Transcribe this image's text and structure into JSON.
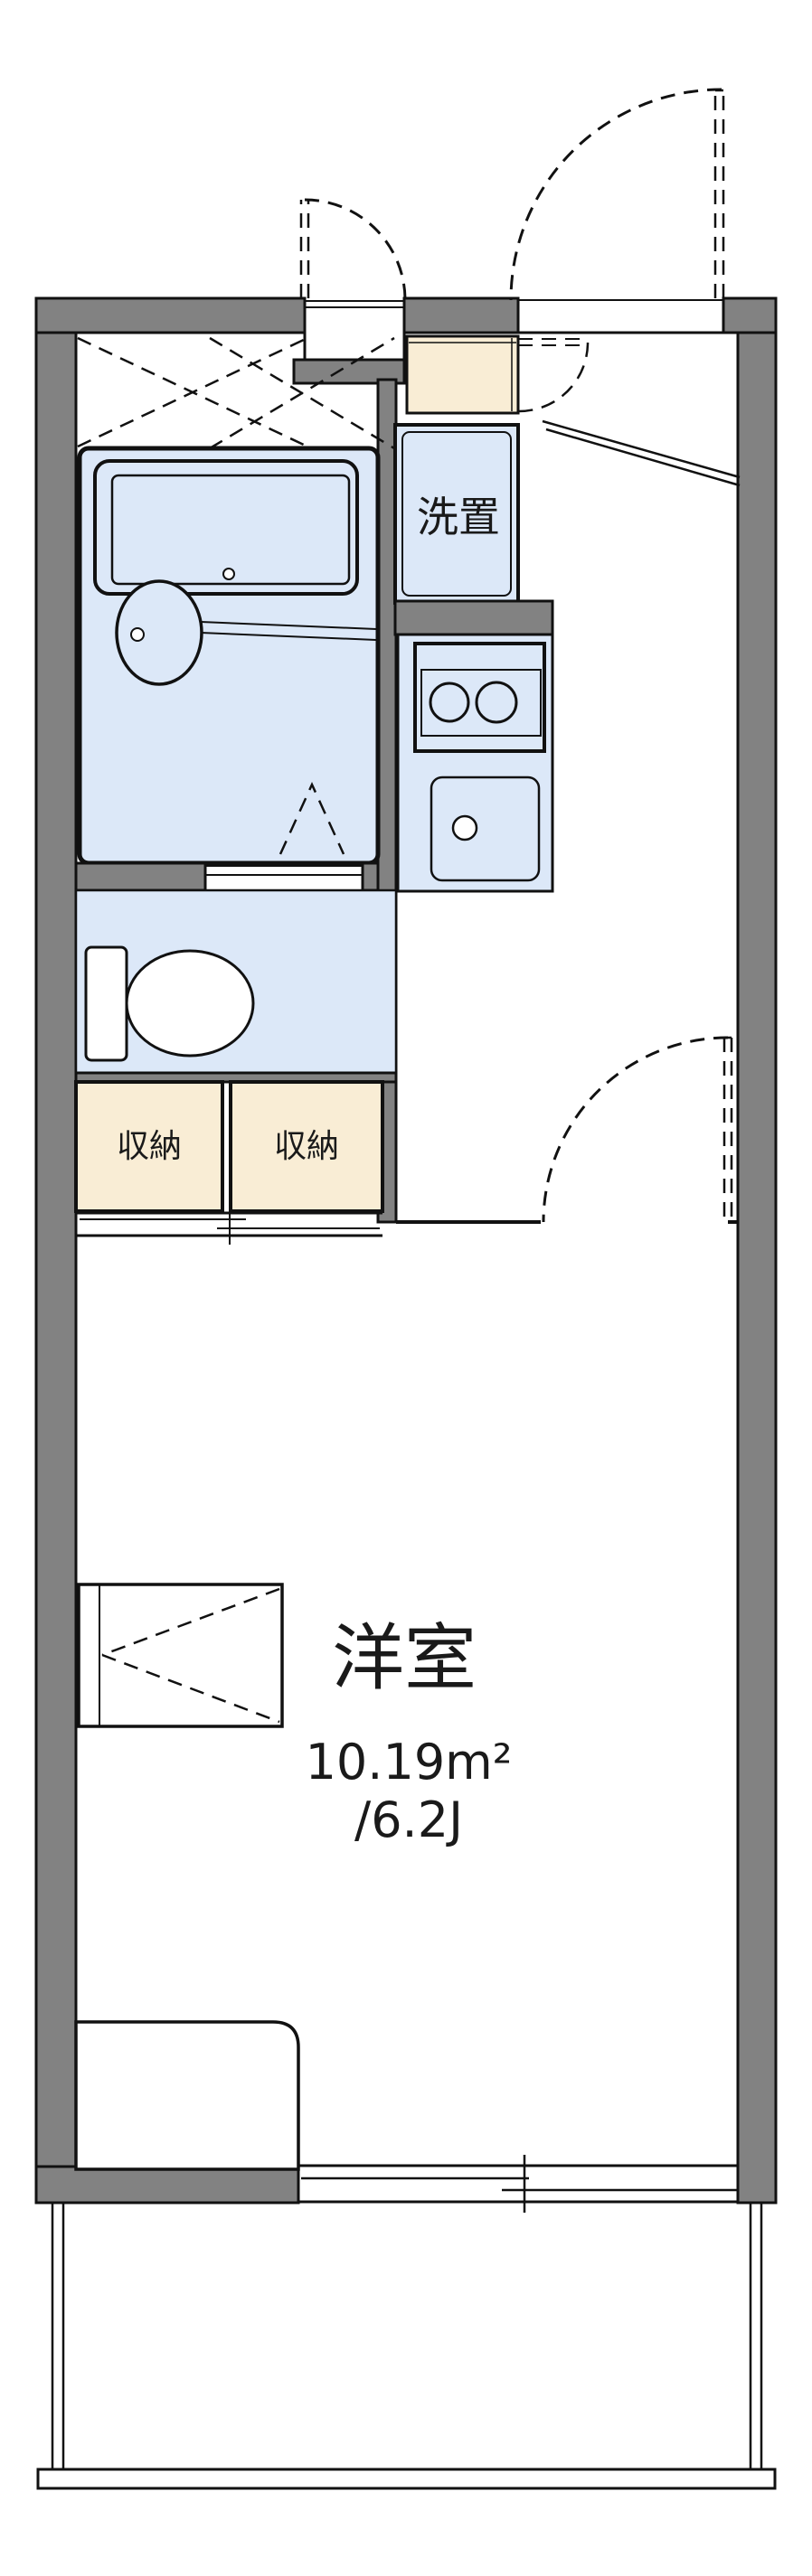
{
  "diagram": {
    "kind": "apartment-floor-plan",
    "orientation": "vertical, balcony at bottom, entrance at top"
  },
  "labels": {
    "western_room": "洋室",
    "western_room_area_m2": "10.19m²",
    "western_room_area_tatami": "/6.2J",
    "storage_left": "収納",
    "storage_right": "収納",
    "washing_machine": "洗置"
  },
  "colors": {
    "wall": "#828282",
    "wet": "#dce8f8",
    "stor": "#f9edd5",
    "line": "#111111",
    "bg": "#ffffff"
  }
}
